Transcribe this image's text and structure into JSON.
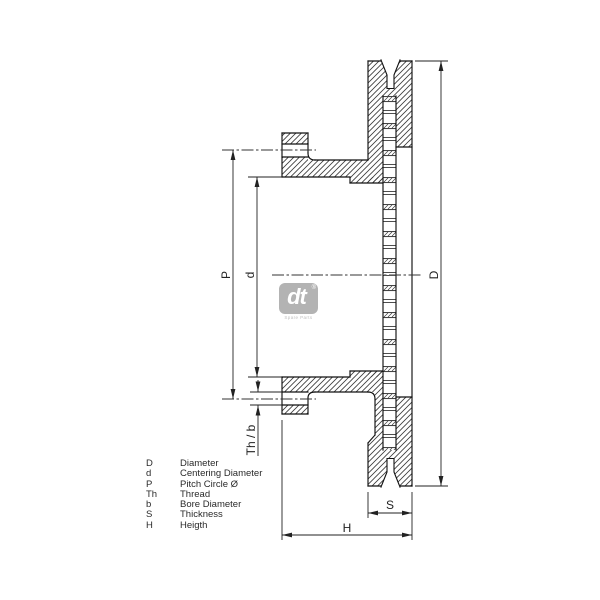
{
  "drawing": {
    "description": "Brake disc cross-section technical drawing"
  },
  "dimensions": {
    "D": "D",
    "d": "d",
    "P": "P",
    "Th_b": "Th / b",
    "S": "S",
    "H": "H"
  },
  "legend": {
    "items": [
      {
        "symbol": "D",
        "description": "Diameter"
      },
      {
        "symbol": "d",
        "description": "Centering Diameter"
      },
      {
        "symbol": "P",
        "description": "Pitch Circle Ø"
      },
      {
        "symbol": "Th",
        "description": "Thread"
      },
      {
        "symbol": "b",
        "description": "Bore Diameter"
      },
      {
        "symbol": "S",
        "description": "Thickness"
      },
      {
        "symbol": "H",
        "description": "Heigth"
      }
    ]
  },
  "logo": {
    "mark": "dt",
    "registered": "®",
    "subtext": "Spare Parts"
  },
  "colors": {
    "background": "#ffffff",
    "outline": "#111111",
    "dimension": "#222222",
    "hatch": "#3a3a3a",
    "centerline": "#333333",
    "logo_gray": "#b3b3b3",
    "logo_text": "#ffffff",
    "legend_text": "#2a2a2a"
  }
}
